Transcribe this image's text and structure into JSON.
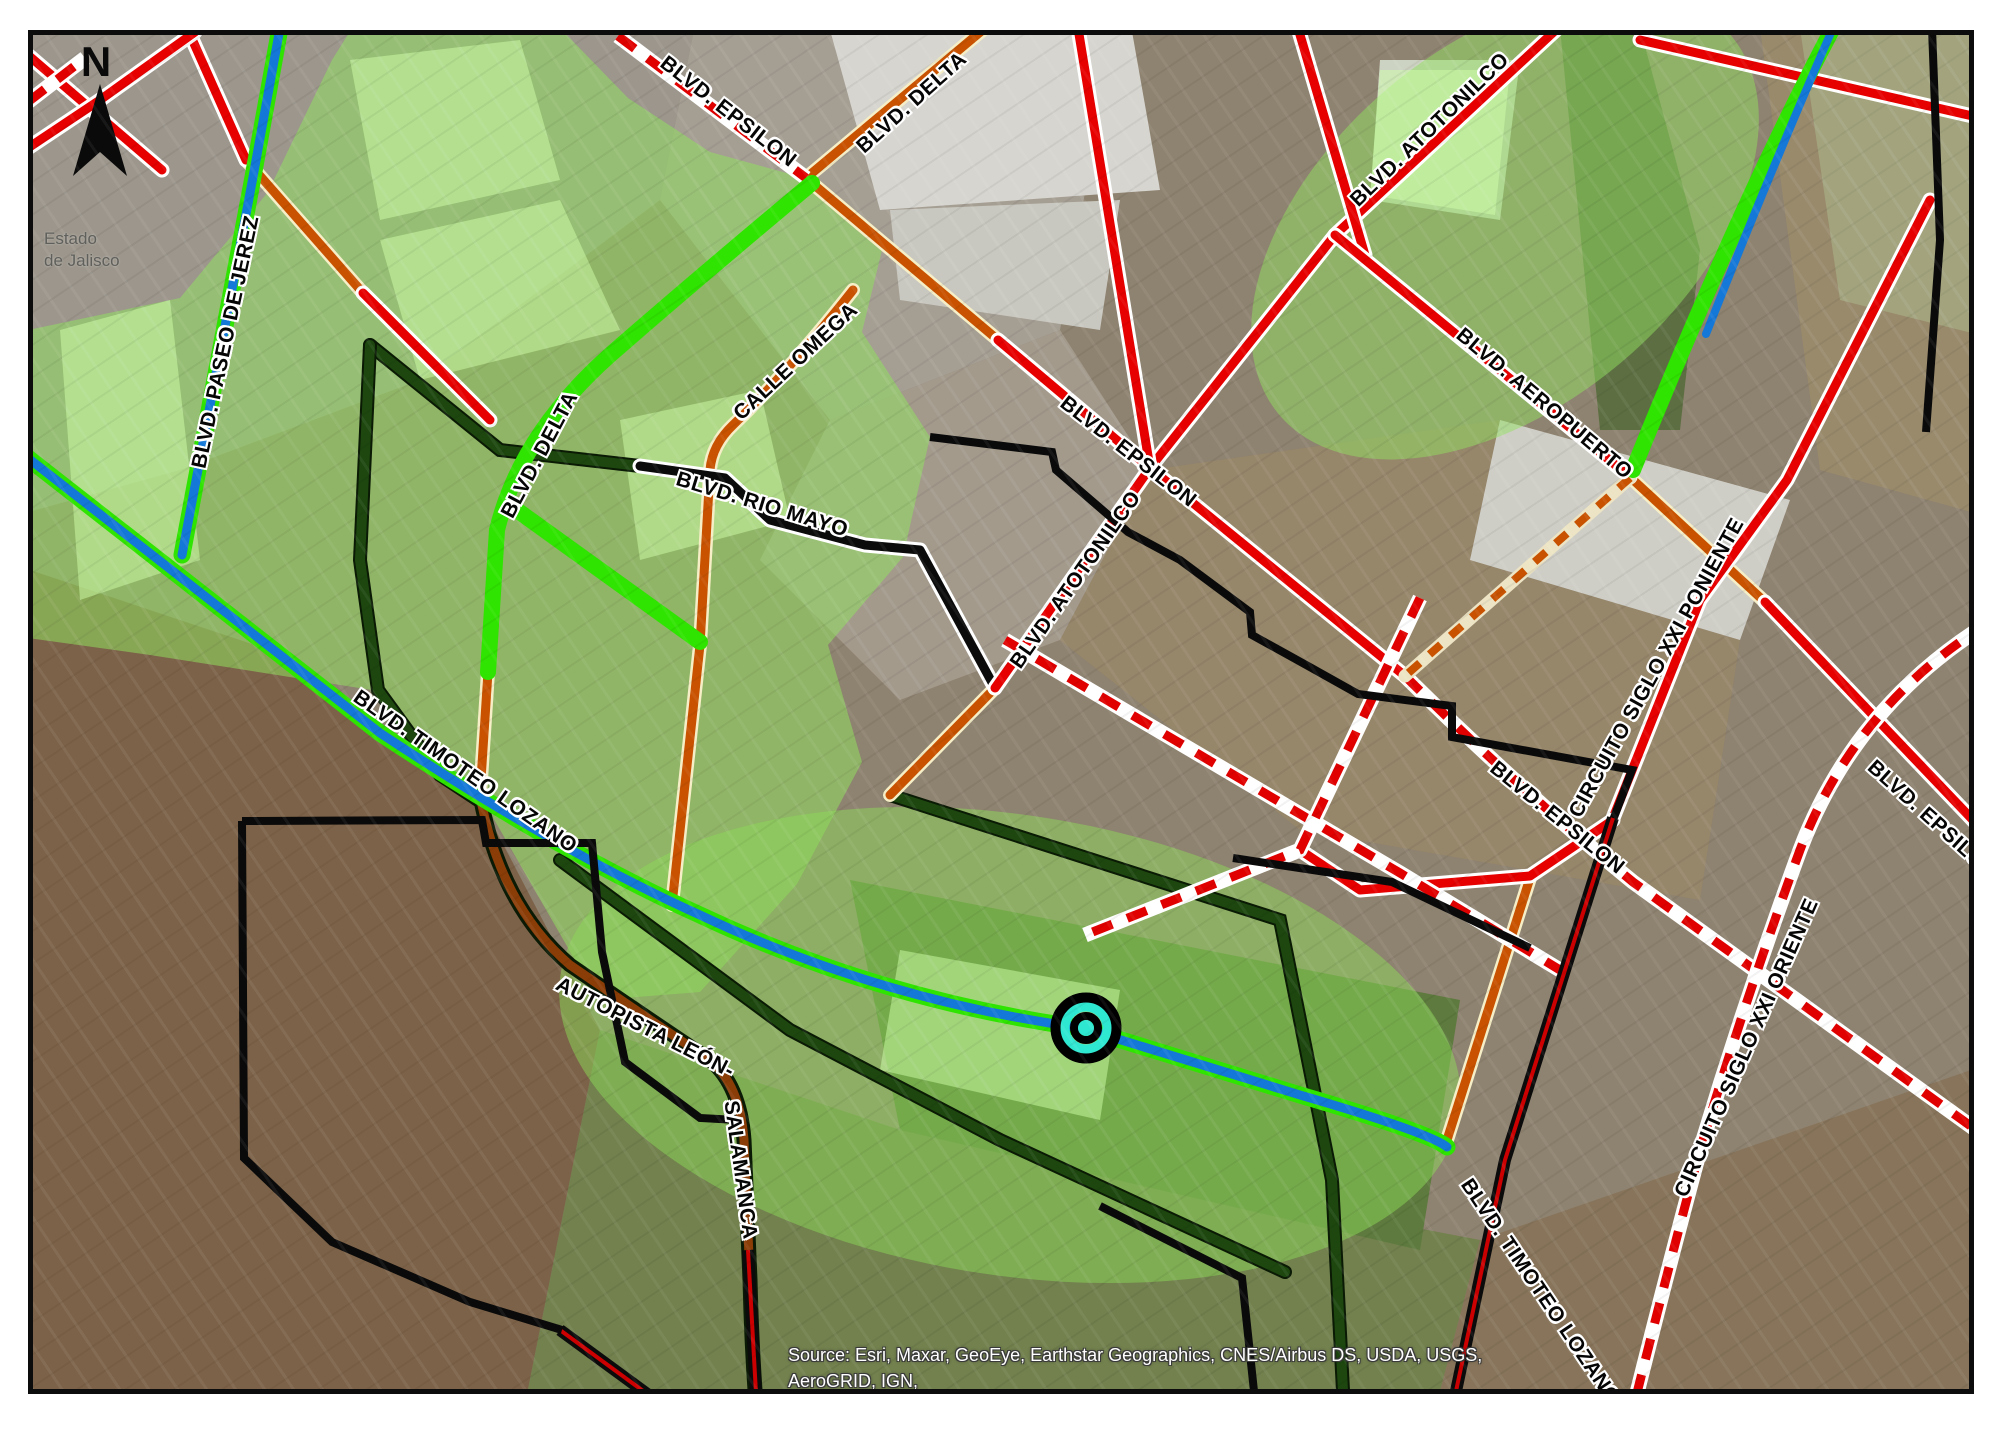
{
  "map": {
    "north_arrow": {
      "label": "N"
    },
    "region_label": {
      "line1": "Estado",
      "line2": "de Jalisco"
    },
    "attribution": {
      "line1": "Source: Esri, Maxar, GeoEye, Earthstar Geographics, CNES/Airbus DS, USDA, USGS, AeroGRID, IGN,",
      "line2": "and the GIS User Community"
    },
    "road_labels": [
      {
        "id": "blvd-epsilon-nw",
        "text": "BLVD. EPSILON"
      },
      {
        "id": "blvd-delta-north",
        "text": "BLVD. DELTA"
      },
      {
        "id": "blvd-atotonilco-ne",
        "text": "BLVD. ATOTONILCO"
      },
      {
        "id": "blvd-paseo-de-jerez",
        "text": "BLVD. PASEO DE JEREZ"
      },
      {
        "id": "calle-omega",
        "text": "CALLE OMEGA"
      },
      {
        "id": "blvd-delta-west",
        "text": "BLVD. DELTA"
      },
      {
        "id": "blvd-rio-mayo",
        "text": "BLVD. RIO MAYO"
      },
      {
        "id": "blvd-epsilon-center",
        "text": "BLVD. EPSILON"
      },
      {
        "id": "blvd-atotonilco-c",
        "text": "BLVD. ATOTONILCO"
      },
      {
        "id": "blvd-aeropuerto",
        "text": "BLVD. AEROPUERTO"
      },
      {
        "id": "circuito-siglo-xxi-poniente",
        "text": "CIRCUITO SIGLO XXI PONIENTE"
      },
      {
        "id": "blvd-epsilon-se",
        "text": "BLVD. EPSILON"
      },
      {
        "id": "blvd-epsilon-east",
        "text": "BLVD. EPSILON"
      },
      {
        "id": "circuito-siglo-xxi-oriente",
        "text": "CIRCUITO SIGLO XXI ORIENTE"
      },
      {
        "id": "blvd-timoteo-lozano-w",
        "text": "BLVD. TIMOTEO LOZANO"
      },
      {
        "id": "blvd-timoteo-lozano-se",
        "text": "BLVD. TIMOTEO LOZANO"
      },
      {
        "id": "autopista-leon",
        "text": "AUTOPISTA LEÓN-"
      },
      {
        "id": "autopista-salamanca",
        "text": "SALAMANCA"
      }
    ],
    "icons": {
      "north_arrow": "dart-compass-pointer",
      "selected_point_marker": "concentric-circles"
    },
    "colors": {
      "road_red": "#e60000",
      "road_red_dashed": "#e00000",
      "road_orange": "#c85200",
      "road_blue": "#1478d8",
      "road_green_highlight": "#2fe400",
      "road_dark_green": "#1d470f",
      "road_brown": "#8a3d07",
      "road_black": "#0b0b0b",
      "boundary_black": "#0a0a0a",
      "marker_cyan": "#2fe8d2",
      "zone_overlay_green": "#92e060",
      "label_halo": "#ffffff",
      "frame_black": "#0c0c0c"
    }
  }
}
